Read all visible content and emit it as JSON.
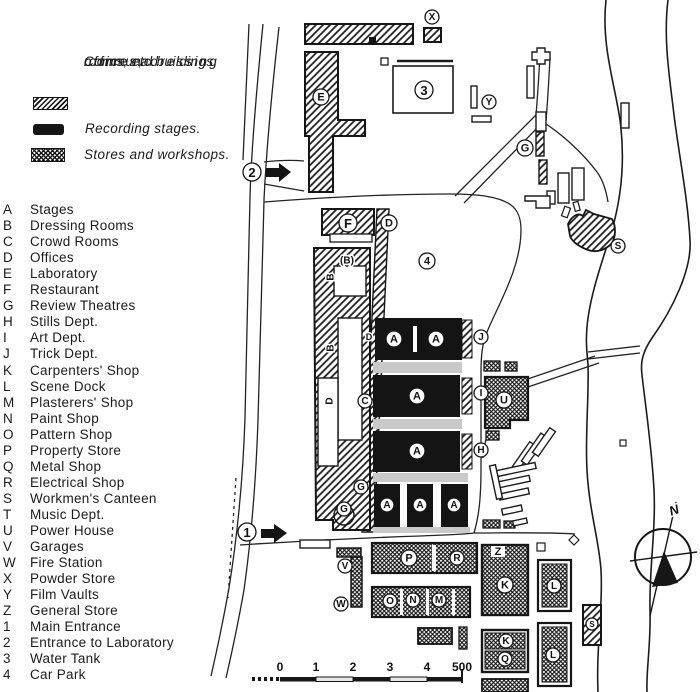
{
  "legend": {
    "items": [
      {
        "swatch": "hatch",
        "label_lines": [
          "Communal buildings,",
          "offices, dressing",
          "rooms, etc."
        ]
      },
      {
        "swatch": "solid",
        "label_lines": [
          "Recording stages."
        ]
      },
      {
        "swatch": "crosshatch",
        "label_lines": [
          "Stores and workshops."
        ]
      }
    ]
  },
  "key": {
    "items": [
      {
        "code": "A",
        "label": "Stages"
      },
      {
        "code": "B",
        "label": "Dressing Rooms"
      },
      {
        "code": "C",
        "label": "Crowd Rooms"
      },
      {
        "code": "D",
        "label": "Offices"
      },
      {
        "code": "E",
        "label": "Laboratory"
      },
      {
        "code": "F",
        "label": "Restaurant"
      },
      {
        "code": "G",
        "label": "Review Theatres"
      },
      {
        "code": "H",
        "label": "Stills Dept."
      },
      {
        "code": "I",
        "label": "Art Dept."
      },
      {
        "code": "J",
        "label": "Trick Dept."
      },
      {
        "code": "K",
        "label": "Carpenters' Shop"
      },
      {
        "code": "L",
        "label": "Scene Dock"
      },
      {
        "code": "M",
        "label": "Plasterers' Shop"
      },
      {
        "code": "N",
        "label": "Paint Shop"
      },
      {
        "code": "O",
        "label": "Pattern Shop"
      },
      {
        "code": "P",
        "label": "Property Store"
      },
      {
        "code": "Q",
        "label": "Metal Shop"
      },
      {
        "code": "R",
        "label": "Electrical Shop"
      },
      {
        "code": "S",
        "label": "Workmen's Canteen"
      },
      {
        "code": "T",
        "label": "Music Dept."
      },
      {
        "code": "U",
        "label": "Power House"
      },
      {
        "code": "V",
        "label": "Garages"
      },
      {
        "code": "W",
        "label": "Fire Station"
      },
      {
        "code": "X",
        "label": "Powder Store"
      },
      {
        "code": "Y",
        "label": "Film Vaults"
      },
      {
        "code": "Z",
        "label": "General Store"
      },
      {
        "code": "1",
        "label": "Main Entrance"
      },
      {
        "code": "2",
        "label": "Entrance to Laboratory"
      },
      {
        "code": "3",
        "label": "Water Tank"
      },
      {
        "code": "4",
        "label": "Car Park"
      }
    ]
  },
  "map": {
    "labels": [
      {
        "t": "X",
        "x": 432,
        "y": 17,
        "r": 7
      },
      {
        "t": "3",
        "x": 424,
        "y": 90,
        "r": 9
      },
      {
        "t": "Y",
        "x": 489,
        "y": 102,
        "r": 7
      },
      {
        "t": "G",
        "x": 525,
        "y": 148,
        "r": 8
      },
      {
        "t": "2",
        "x": 252,
        "y": 172,
        "r": 9
      },
      {
        "t": "E",
        "x": 321,
        "y": 97,
        "r": 8
      },
      {
        "t": "F",
        "x": 348,
        "y": 223,
        "r": 9
      },
      {
        "t": "D",
        "x": 389,
        "y": 223,
        "r": 8
      },
      {
        "t": "4",
        "x": 427,
        "y": 261,
        "r": 8
      },
      {
        "t": "A",
        "x": 394,
        "y": 339,
        "r": 8
      },
      {
        "t": "A",
        "x": 436,
        "y": 339,
        "r": 8
      },
      {
        "t": "J",
        "x": 481,
        "y": 337,
        "r": 7
      },
      {
        "t": "A",
        "x": 417,
        "y": 396,
        "r": 8
      },
      {
        "t": "I",
        "x": 481,
        "y": 393,
        "r": 7
      },
      {
        "t": "U",
        "x": 504,
        "y": 400,
        "r": 8
      },
      {
        "t": "A",
        "x": 417,
        "y": 451,
        "r": 8
      },
      {
        "t": "H",
        "x": 481,
        "y": 450,
        "r": 7
      },
      {
        "t": "C",
        "x": 365,
        "y": 401,
        "r": 7
      },
      {
        "t": "G",
        "x": 361,
        "y": 487,
        "r": 7
      },
      {
        "t": "G",
        "x": 344,
        "y": 509,
        "r": 7
      },
      {
        "t": "A",
        "x": 387,
        "y": 505,
        "r": 7
      },
      {
        "t": "A",
        "x": 420,
        "y": 505,
        "r": 7
      },
      {
        "t": "A",
        "x": 454,
        "y": 505,
        "r": 7
      },
      {
        "t": "1",
        "x": 247,
        "y": 532,
        "r": 9
      },
      {
        "t": "V",
        "x": 345,
        "y": 566,
        "r": 7
      },
      {
        "t": "W",
        "x": 341,
        "y": 604,
        "r": 7
      },
      {
        "t": "S",
        "x": 618,
        "y": 246,
        "r": 7
      },
      {
        "t": "P",
        "x": 409,
        "y": 558,
        "r": 8
      },
      {
        "t": "R",
        "x": 457,
        "y": 558,
        "r": 7
      },
      {
        "t": "O",
        "x": 390,
        "y": 601,
        "r": 7
      },
      {
        "t": "N",
        "x": 413,
        "y": 600,
        "r": 7
      },
      {
        "t": "M",
        "x": 439,
        "y": 600,
        "r": 7
      },
      {
        "t": "K",
        "x": 505,
        "y": 585,
        "r": 8
      },
      {
        "t": "L",
        "x": 554,
        "y": 586,
        "r": 7
      },
      {
        "t": "K",
        "x": 506,
        "y": 641,
        "r": 7
      },
      {
        "t": "Q",
        "x": 505,
        "y": 659,
        "r": 7
      },
      {
        "t": "L",
        "x": 553,
        "y": 655,
        "r": 7
      },
      {
        "t": "S",
        "x": 592,
        "y": 624,
        "r": 6
      }
    ],
    "plain_labels": [
      {
        "t": "(B)",
        "x": 347,
        "y": 261,
        "size": 10
      },
      {
        "t": "B",
        "x": 331,
        "y": 277,
        "size": 10,
        "rot": -90
      },
      {
        "t": "B",
        "x": 331,
        "y": 348,
        "size": 10,
        "rot": -90
      },
      {
        "t": "D",
        "x": 330,
        "y": 401,
        "size": 10,
        "rot": -90
      },
      {
        "t": "D",
        "x": 369,
        "y": 337,
        "size": 9
      },
      {
        "t": "Z",
        "x": 498,
        "y": 552,
        "size": 11
      },
      {
        "t": "N",
        "x": 674,
        "y": 510,
        "size": 13,
        "rot": -20,
        "italic": true
      }
    ],
    "scale_bar": {
      "tick_labels": [
        "0",
        "1",
        "2",
        "3",
        "4",
        "500"
      ]
    },
    "compass": {
      "label": "N"
    }
  }
}
